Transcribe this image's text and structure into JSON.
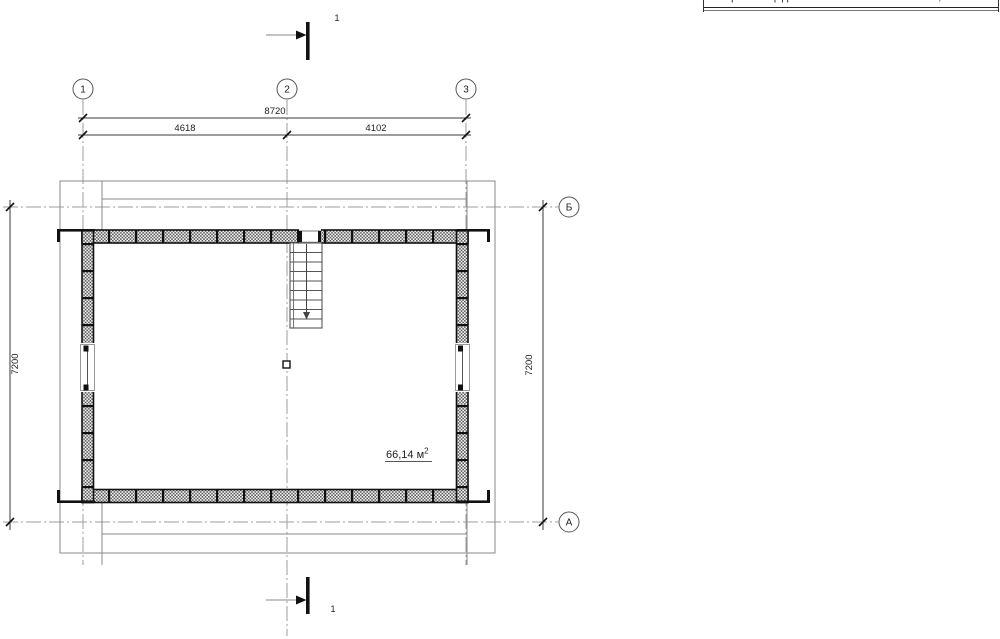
{
  "drawing": {
    "grid": {
      "columns": [
        {
          "label": "1"
        },
        {
          "label": "2"
        },
        {
          "label": "3"
        }
      ],
      "rows": [
        {
          "label": "Б"
        },
        {
          "label": "А"
        }
      ]
    },
    "dimensions": {
      "total_width": "8720",
      "left_bay": "4618",
      "right_bay": "4102",
      "height_left": "7200",
      "height_right": "7200"
    },
    "section": {
      "top_label": "1",
      "bottom_label": "1"
    },
    "room": {
      "area_value": "66,14 м",
      "area_sup": "2"
    }
  },
  "table_fragment": {
    "label": "Общая площадь",
    "value": "66,14"
  },
  "colors": {
    "ink": "#1a1a1a",
    "thin_line": "#8a8a8a",
    "axis_line": "#9e9e9e",
    "dim_line": "#3a3a3a"
  }
}
